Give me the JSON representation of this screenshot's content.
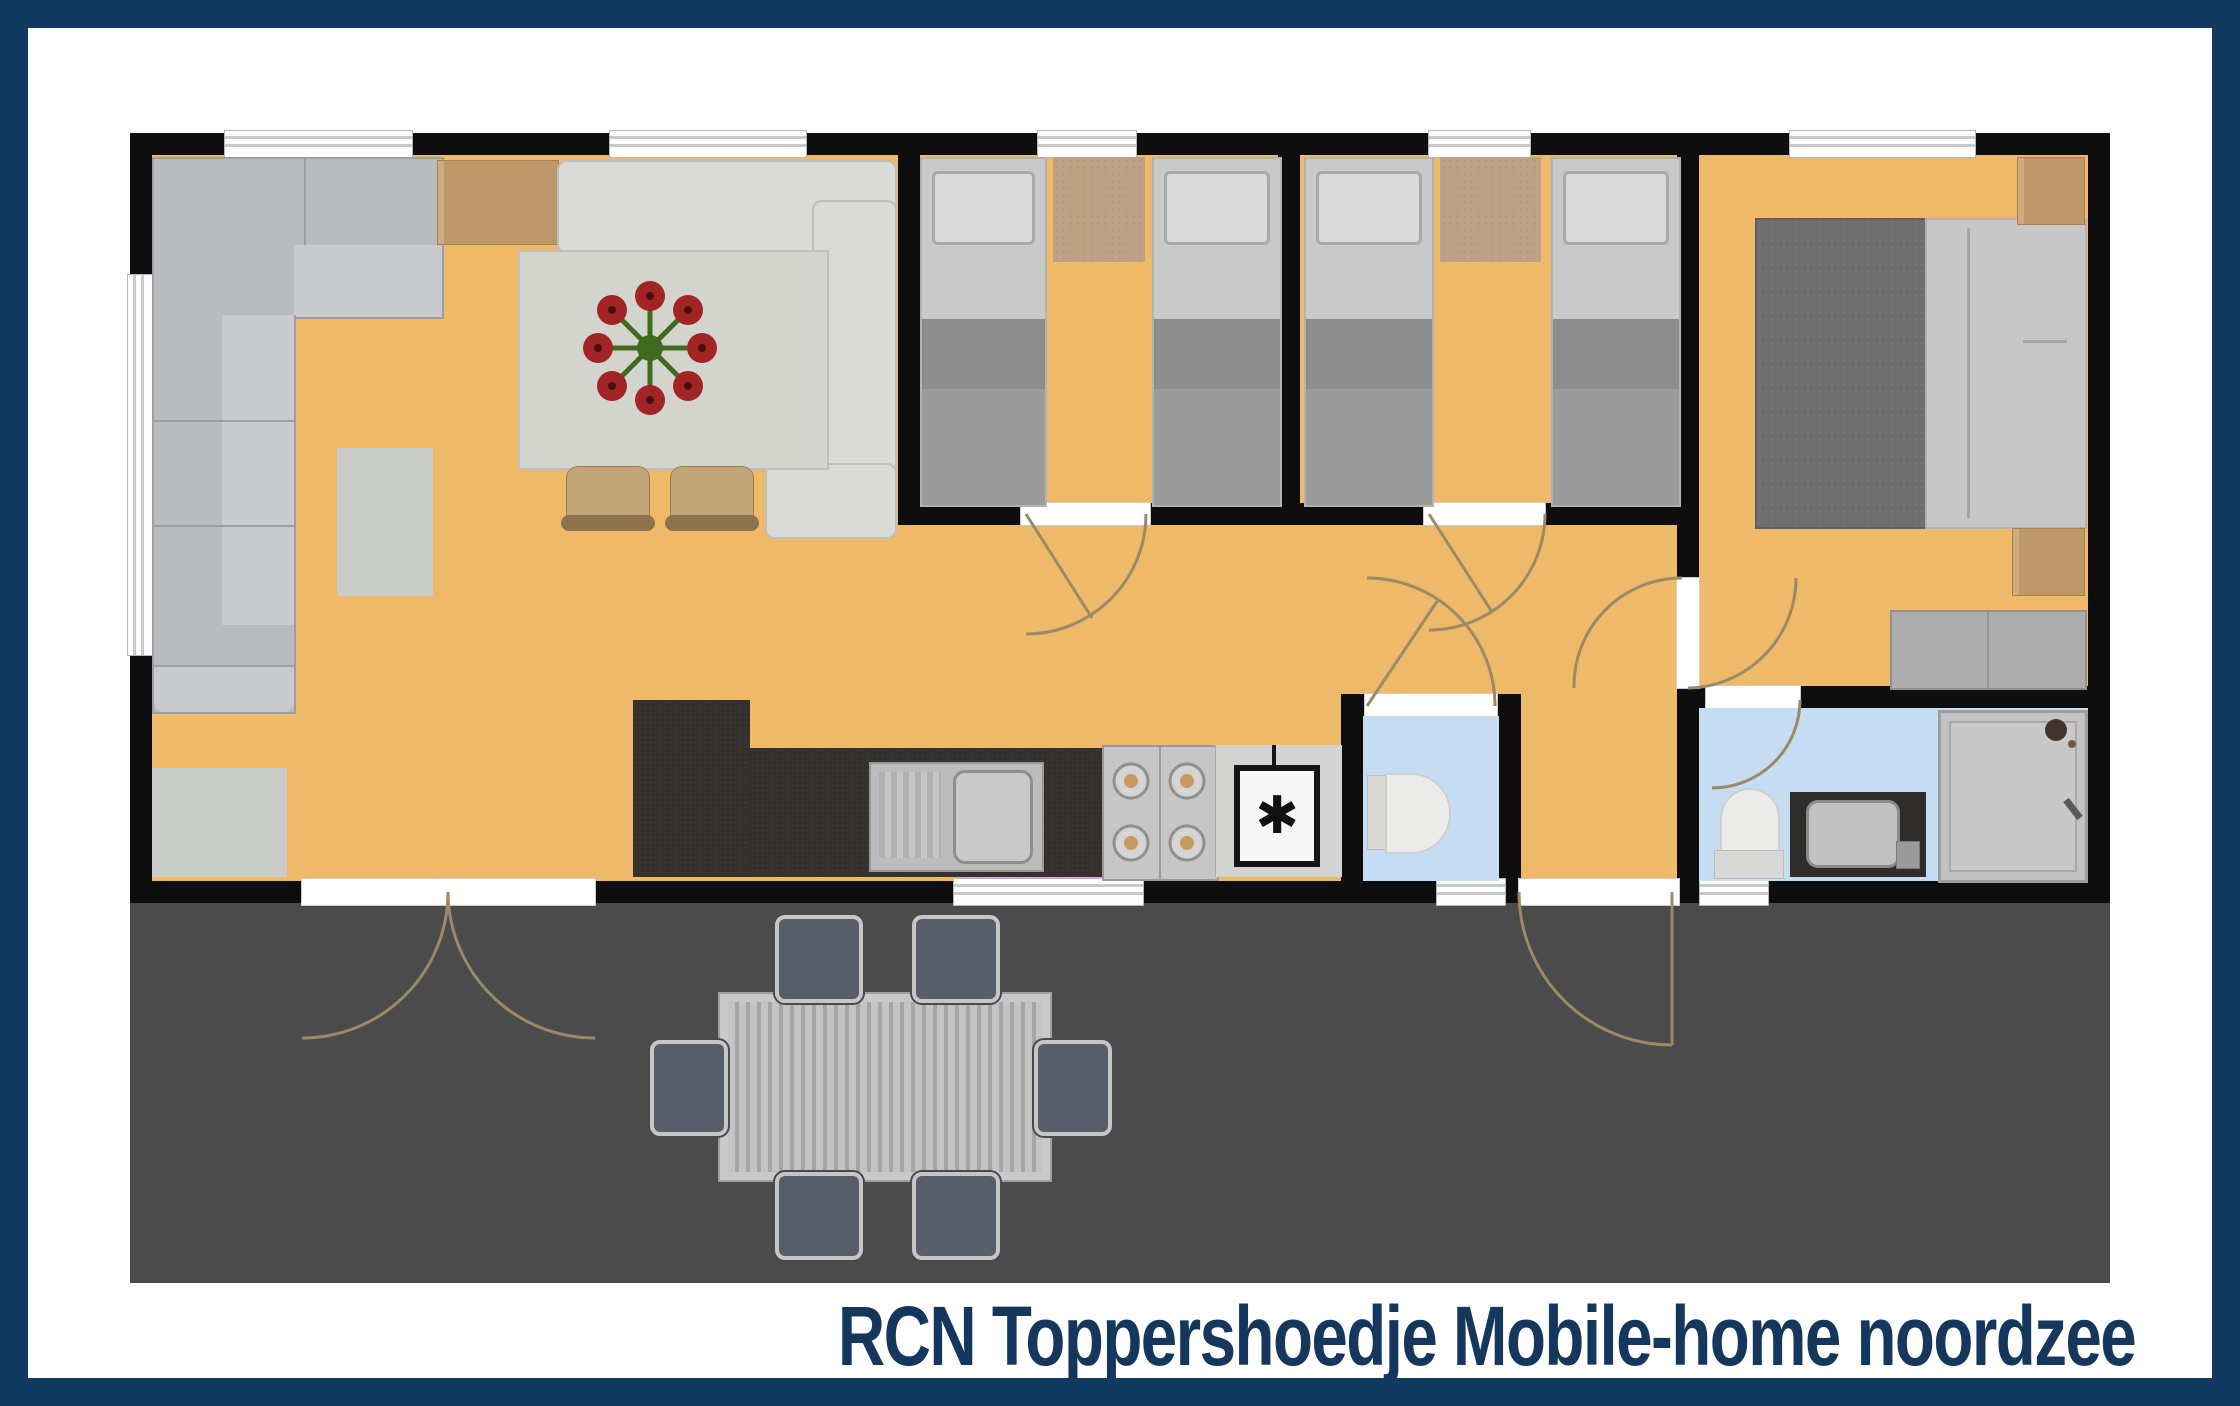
{
  "title": {
    "text": "RCN Toppershoedje Mobile-home noordzee"
  },
  "icons": {
    "freezer_symbol": "✱"
  },
  "palette": {
    "frame_navy": "#12395f",
    "floor_orange": "#efb96a",
    "wall_black": "#0e0e0e",
    "deck_gray": "#4b4b4b",
    "bathroom_floor_blue": "#c6dcf2",
    "wood_tan": "#c8a06e",
    "rug_tan": "#bfa285",
    "sofa_gray": "#b9bbbe",
    "kitchen_counter_dark": "#34312d",
    "bed_blanket_gray": "#9b9b9b",
    "master_blanket_gray": "#6e6e6e",
    "outdoor_chair_slate": "#575d69",
    "flower_red": "#a32424",
    "flower_green": "#3e6b1e"
  }
}
